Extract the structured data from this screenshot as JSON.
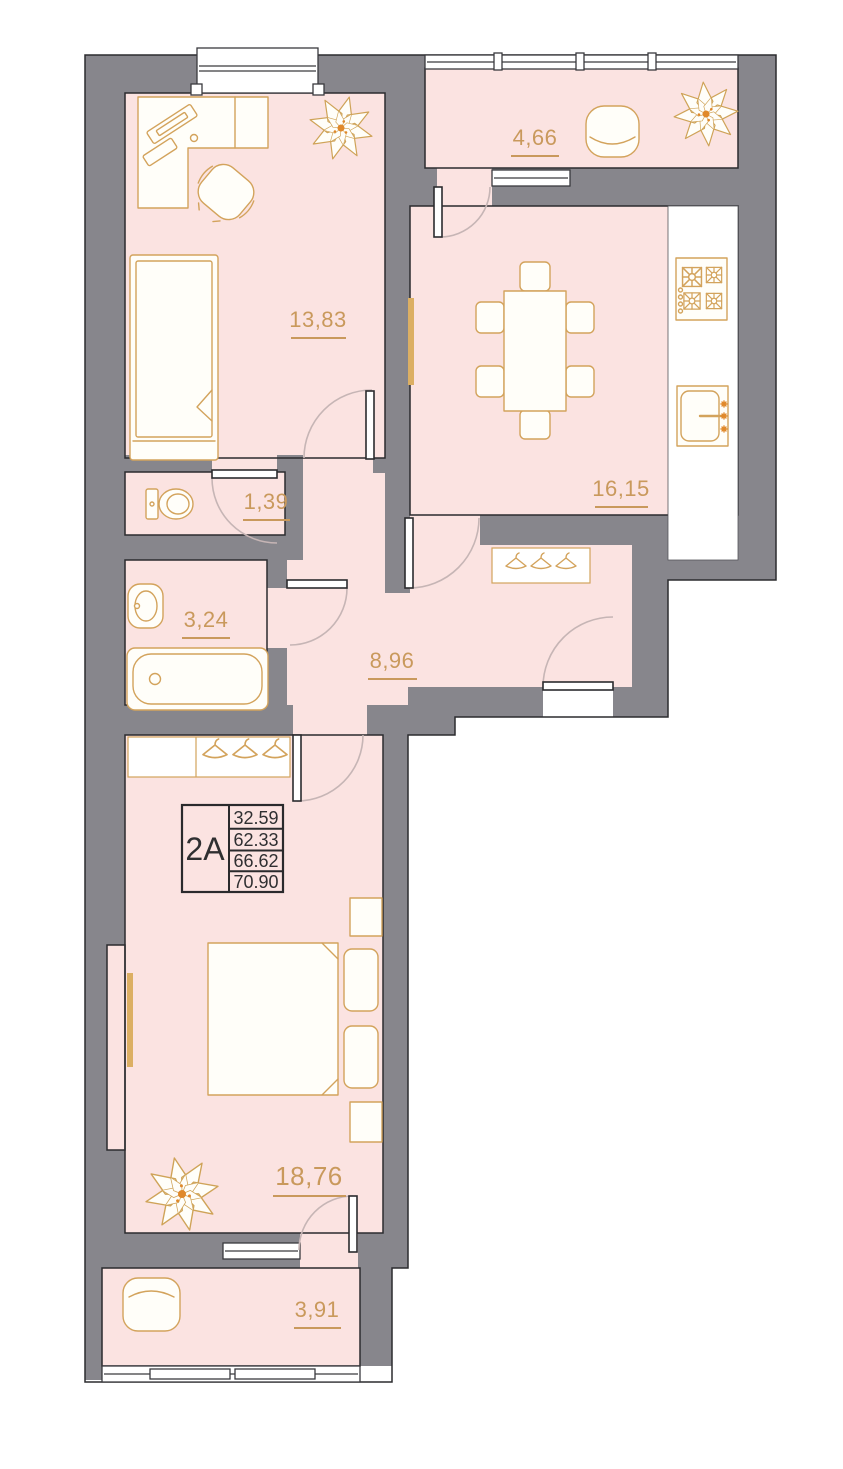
{
  "plan": {
    "title": "Apartment floor plan",
    "unit_label": "2A",
    "unit_table": {
      "values": [
        "32.59",
        "62.33",
        "66.62",
        "70.90"
      ]
    },
    "rooms": [
      {
        "id": "bedroom-top",
        "area": "13,83"
      },
      {
        "id": "balcony-top",
        "area": "4,66"
      },
      {
        "id": "kitchen",
        "area": "16,15"
      },
      {
        "id": "wc",
        "area": "1,39"
      },
      {
        "id": "bathroom",
        "area": "3,24"
      },
      {
        "id": "hallway",
        "area": "8,96"
      },
      {
        "id": "bedroom-main",
        "area": "18,76"
      },
      {
        "id": "balcony-bottom",
        "area": "3,91"
      }
    ],
    "colors": {
      "wall": "#87868c",
      "room_fill": "#fbe3e1",
      "furniture_stroke": "#d3a35c",
      "label_text": "#c9995c",
      "outline": "#2b2b2e",
      "door_arc": "#c6b5b5",
      "accent_orange": "#e0882a",
      "table_text": "#2f2f31"
    },
    "icons": [
      "plant-icon",
      "single-bed-icon",
      "double-bed-icon",
      "desk-icon",
      "office-chair-icon",
      "pouf-icon",
      "armchair-icon",
      "dining-table-icon",
      "dining-chair-icon",
      "stove-icon",
      "kitchen-sink-icon",
      "toilet-icon",
      "washbasin-icon",
      "bathtub-icon",
      "coat-rack-icon",
      "wardrobe-icon",
      "radiator-icon",
      "window-icon",
      "door-icon"
    ]
  }
}
